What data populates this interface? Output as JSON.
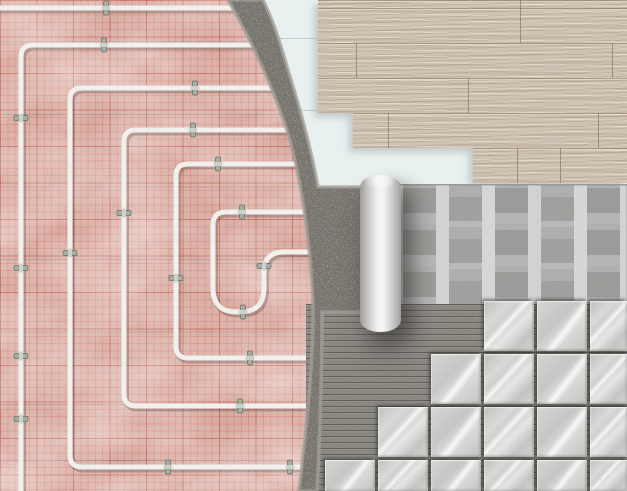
{
  "scene": {
    "subject": "underfloor-heating-floor-construction-layers",
    "layers": [
      "insulation-mat-with-heating-pipes",
      "screed",
      "underlay",
      "wood-laminate",
      "membrane-roll",
      "tile-adhesive-ridges",
      "marble-tiles"
    ]
  },
  "palette": {
    "mat_pink": "#d7aaa0",
    "grid_red_minor": "rgba(205,90,74,0.30)",
    "grid_red_major": "rgba(186,58,46,0.45)",
    "mat_seam": "rgba(108,103,110,0.35)",
    "pipe": "#f1f0ed",
    "pipe_clip": "#a4ada3",
    "screed": "#76736d",
    "screed_edge": "#a49f97",
    "underlay_blue": "#e9f1f0",
    "wood_base": "#cfc3b2",
    "wood_grain_dark": "#846e56",
    "membrane_base": "#b2b0ae",
    "membrane_bar_light": "#d8d6d4",
    "membrane_block_dark": "#9d9b99",
    "roll_highlight": "#f7f6f4",
    "adhesive": "#8b8882",
    "adhesive_ridge_dark": "#3a3834",
    "tile_light": "#e6e6e4",
    "tile_mid": "#c9c9c7",
    "tile_vein": "#ffffff"
  },
  "mat": {
    "grid_minor_px": 7.3,
    "grid_major_px": 36.5,
    "seam_spacing_px": 72.5
  },
  "heating_pipes": {
    "color": "#f1f0ed",
    "width": 5,
    "paths": [
      "M -6 8 L 240 8",
      "M 266 45 L 33 45 Q 21 45 21 57 L 21 496",
      "M 282 88 L 82 88 Q 70 88 70 100 L 70 455 Q 70 467 82 467 L 308 467",
      "M 296 130 L 136 130 Q 124 130 124 142 L 124 394 Q 124 406 136 406 L 314 406",
      "M 302 164 L 188 164 Q 176 164 176 176 L 176 346 Q 176 358 188 358 L 318 358",
      "M 311 212 L 226 212 Q 213 212 213 225 L 213 288 Q 213 312 237 312 L 240 312 Q 264 312 264 288 L 264 272 Q 264 252 284 252 L 316 252"
    ],
    "clips": [
      {
        "x": 106,
        "y": 8,
        "o": "h"
      },
      {
        "x": 104,
        "y": 45,
        "o": "h"
      },
      {
        "x": 195,
        "y": 88,
        "o": "h"
      },
      {
        "x": 193,
        "y": 130,
        "o": "h"
      },
      {
        "x": 218,
        "y": 164,
        "o": "h"
      },
      {
        "x": 242,
        "y": 212,
        "o": "h"
      },
      {
        "x": 21,
        "y": 118,
        "o": "v"
      },
      {
        "x": 21,
        "y": 268,
        "o": "v"
      },
      {
        "x": 21,
        "y": 356,
        "o": "v"
      },
      {
        "x": 21,
        "y": 419,
        "o": "v"
      },
      {
        "x": 70,
        "y": 253,
        "o": "v"
      },
      {
        "x": 124,
        "y": 213,
        "o": "v"
      },
      {
        "x": 176,
        "y": 278,
        "o": "v"
      },
      {
        "x": 264,
        "y": 266,
        "o": "v"
      },
      {
        "x": 243,
        "y": 312,
        "o": "h"
      },
      {
        "x": 250,
        "y": 358,
        "o": "h"
      },
      {
        "x": 240,
        "y": 406,
        "o": "h"
      },
      {
        "x": 168,
        "y": 467,
        "o": "h"
      },
      {
        "x": 290,
        "y": 467,
        "o": "h"
      }
    ]
  },
  "screed": {
    "fill": "#76736d",
    "edge_color": "#a49f97",
    "path": "M228,0 C250,38 274,88 290,140 C302,185 311,248 313,305 C314,360 306,430 299,491 L317,491 C320,430 322,370 322,312 L381,312 L381,187 L318,187 C311,148 300,108 288,70 C281,46 274,22 263,0 Z"
  },
  "underlay": {
    "joints": [
      {
        "left": 263,
        "top": 38,
        "width": 210,
        "height": 1
      },
      {
        "left": 280,
        "top": 110,
        "width": 193,
        "height": 1
      },
      {
        "left": 352,
        "top": 0,
        "width": 1,
        "height": 110
      }
    ]
  },
  "wood_flooring": {
    "row_height_px": 35,
    "steps": [
      {
        "y": 0,
        "x": 318
      },
      {
        "y": 113,
        "x": 353
      },
      {
        "y": 148,
        "x": 473
      }
    ],
    "bottom_px": 183,
    "joints": [
      {
        "x": 520,
        "top": 0,
        "h": 43
      },
      {
        "x": 356,
        "top": 43,
        "h": 35
      },
      {
        "x": 612,
        "top": 43,
        "h": 35
      },
      {
        "x": 468,
        "top": 78,
        "h": 35
      },
      {
        "x": 388,
        "top": 113,
        "h": 35
      },
      {
        "x": 598,
        "top": 113,
        "h": 35
      },
      {
        "x": 517,
        "top": 148,
        "h": 35
      },
      {
        "x": 560,
        "top": 148,
        "h": 35
      }
    ]
  },
  "tiles": {
    "size": 50,
    "pitch": 53,
    "rows": [
      {
        "top": 301,
        "left": 484
      },
      {
        "top": 354,
        "left": 431
      },
      {
        "top": 407,
        "left": 378
      },
      {
        "top": 460,
        "left": 325
      }
    ]
  }
}
